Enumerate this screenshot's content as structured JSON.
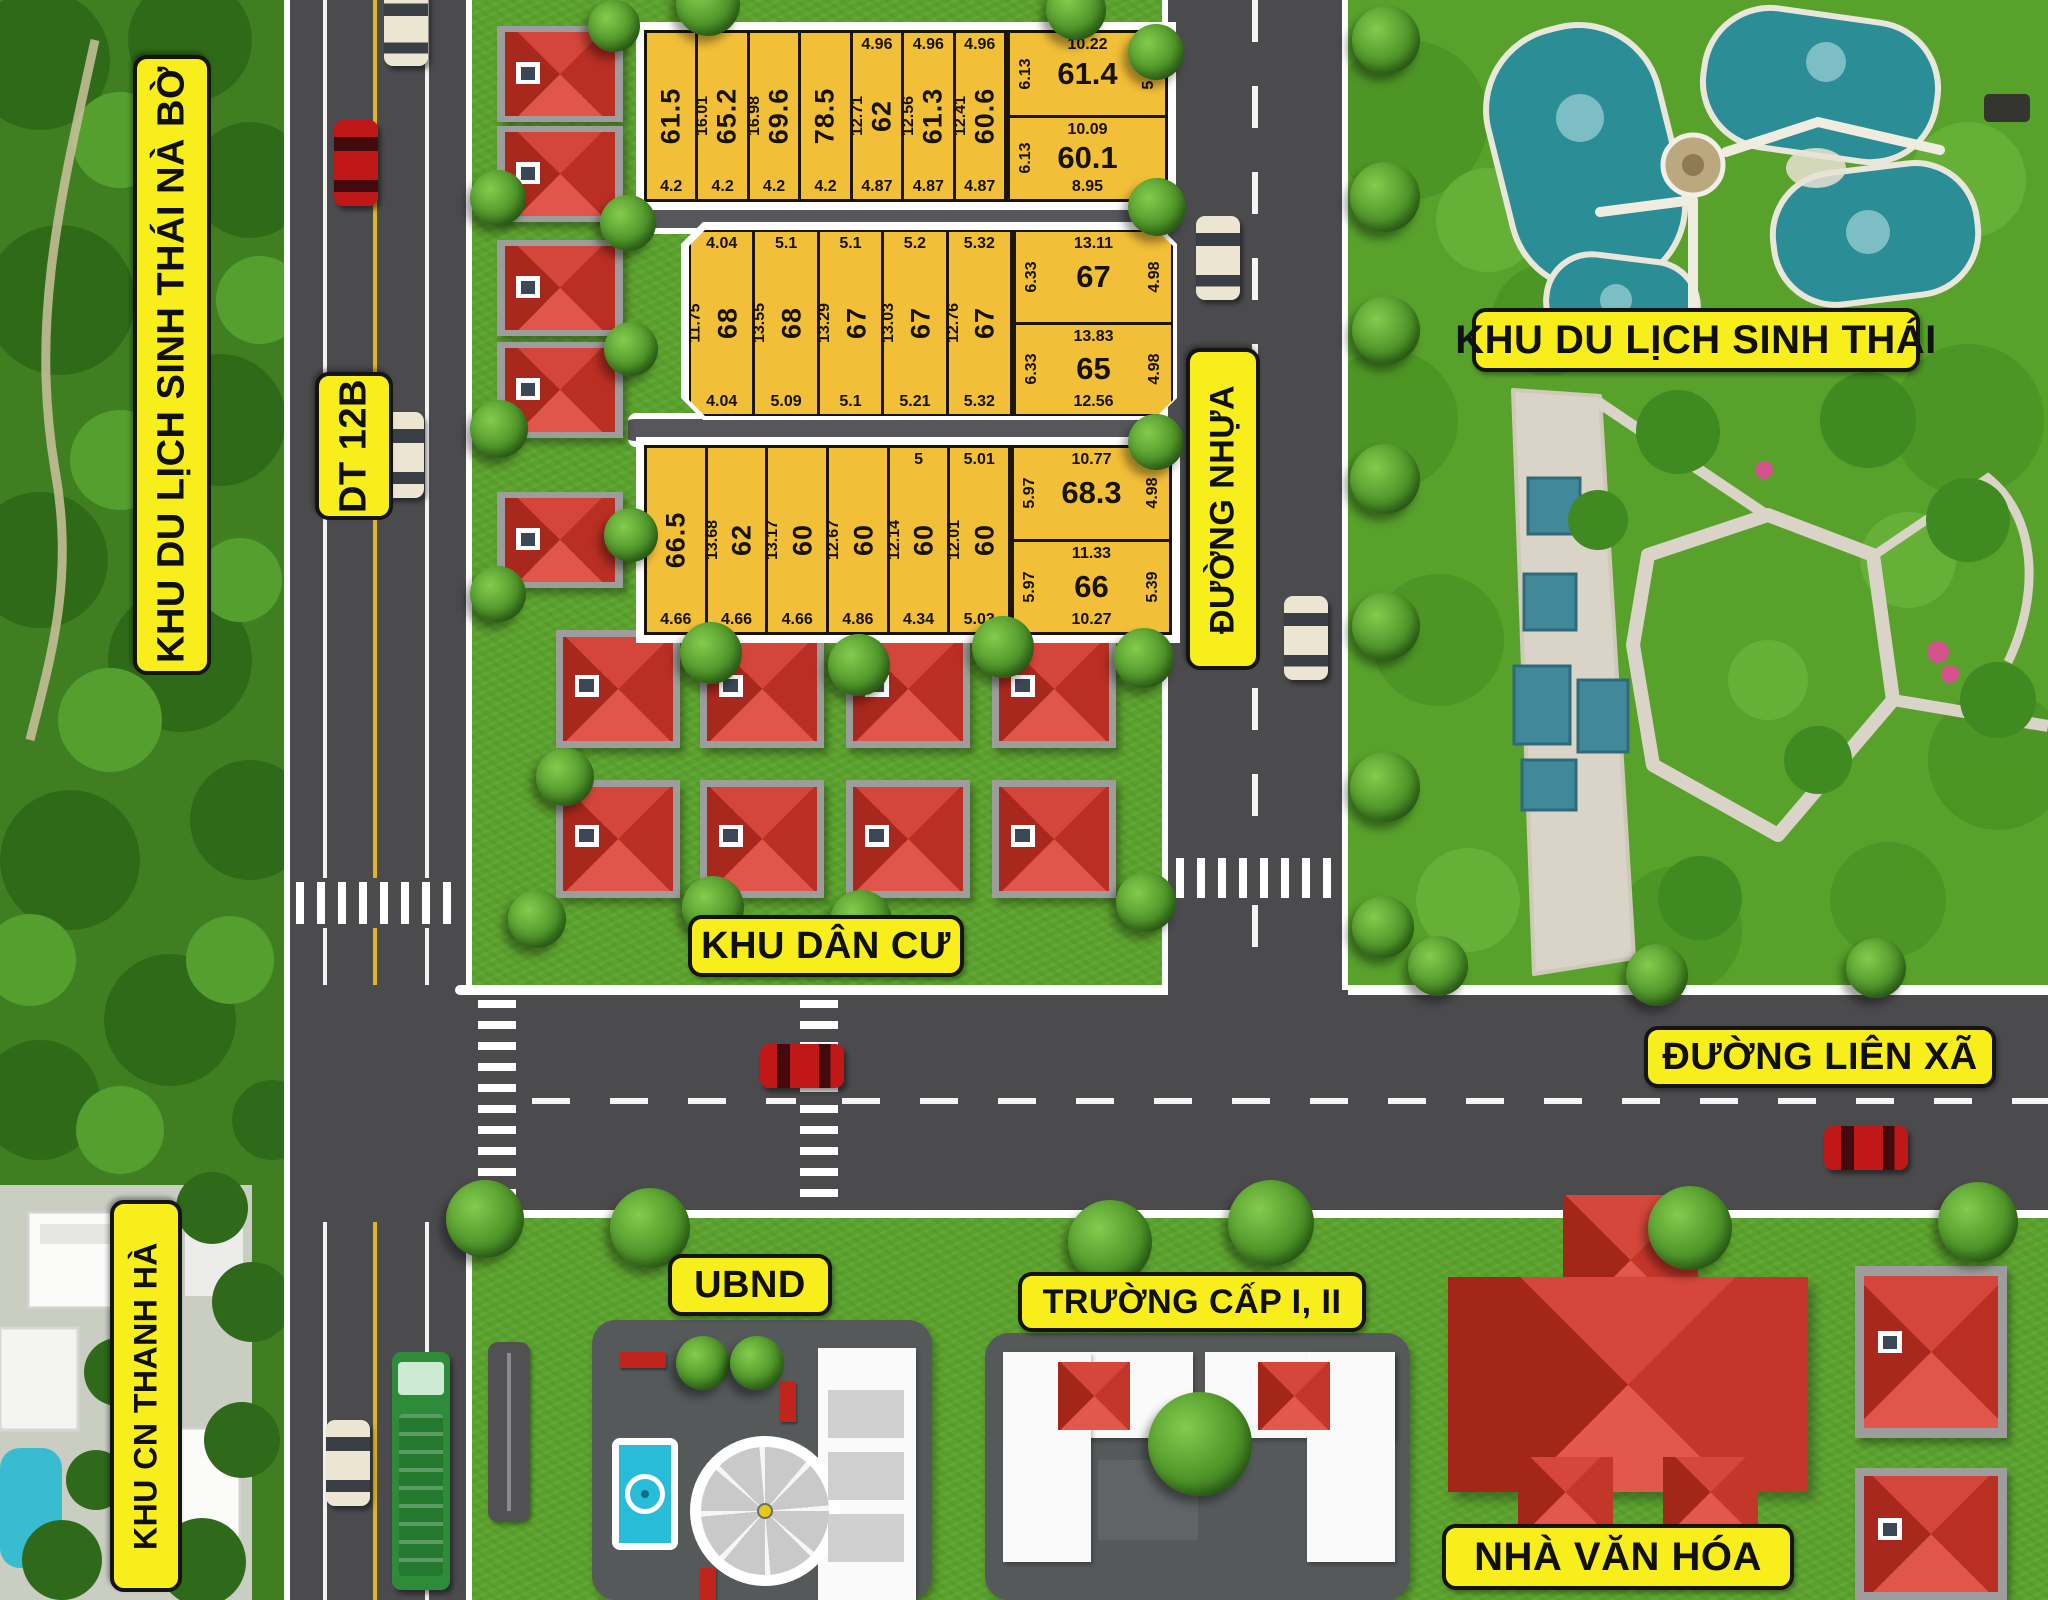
{
  "labels": {
    "zone_eco_naBo": "KHU DU LỊCH SINH THÁI NÀ BỜ",
    "road_dt12b": "DT 12B",
    "zone_eco_park": "KHU DU LỊCH SINH THÁI",
    "road_duong_nhua": "ĐƯỜNG NHỰA",
    "zone_residential": "KHU DÂN CƯ",
    "road_lien_xa": "ĐƯỜNG LIÊN XÃ",
    "ubnd": "UBND",
    "school": "TRƯỜNG CẤP I, II",
    "culture_house": "NHÀ VĂN HÓA",
    "zone_industrial": "KHU CN THANH HÀ"
  },
  "colors": {
    "plot_yellow": "#F2BF38",
    "badge_yellow": "#F7EE1B",
    "road_gray": "#4B4B4E",
    "grass_green": "#5BA22C",
    "roof_red": "#C8382C",
    "pond_teal": "#2B8D96"
  },
  "plot_blocks": {
    "block1": {
      "strips": [
        {
          "area": "61.5",
          "side": "",
          "top": "",
          "bottom": "4.2"
        },
        {
          "area": "65.2",
          "side": "16.01",
          "top": "",
          "bottom": "4.2"
        },
        {
          "area": "69.6",
          "side": "16.98",
          "top": "",
          "bottom": "4.2"
        },
        {
          "area": "78.5",
          "side": "",
          "top": "",
          "bottom": "4.2"
        },
        {
          "area": "62",
          "side": "12.71",
          "top": "4.96",
          "bottom": "4.87"
        },
        {
          "area": "61.3",
          "side": "12.56",
          "top": "4.96",
          "bottom": "4.87"
        },
        {
          "area": "60.6",
          "side": "12.41",
          "top": "4.96",
          "bottom": "4.87"
        }
      ],
      "right_col": [
        {
          "area": "61.4",
          "top": "10.22",
          "left": "6.13",
          "right": "5.98",
          "bottom": ""
        },
        {
          "area": "60.1",
          "top": "10.09",
          "left": "6.13",
          "right": "",
          "bottom": "8.95"
        }
      ]
    },
    "block2": {
      "strips": [
        {
          "area": "68",
          "side": "11.75",
          "top": "4.04",
          "bottom": "4.04"
        },
        {
          "area": "68",
          "side": "13.55",
          "top": "5.1",
          "bottom": "5.09"
        },
        {
          "area": "67",
          "side": "13.29",
          "top": "5.1",
          "bottom": "5.1"
        },
        {
          "area": "67",
          "side": "13.03",
          "top": "5.2",
          "bottom": "5.21"
        },
        {
          "area": "67",
          "side": "12.76",
          "top": "5.32",
          "bottom": "5.32"
        }
      ],
      "right_col": [
        {
          "area": "67",
          "top": "13.11",
          "left": "6.33",
          "right": "4.98",
          "bottom": ""
        },
        {
          "area": "65",
          "top": "13.83",
          "left": "6.33",
          "right": "4.98",
          "bottom": "12.56"
        }
      ]
    },
    "block3": {
      "strips": [
        {
          "area": "66.5",
          "side": "",
          "top": "",
          "bottom": "4.66"
        },
        {
          "area": "62",
          "side": "13.68",
          "top": "",
          "bottom": "4.66"
        },
        {
          "area": "60",
          "side": "13.17",
          "top": "",
          "bottom": "4.66"
        },
        {
          "area": "60",
          "side": "12.67",
          "top": "",
          "bottom": "4.86"
        },
        {
          "area": "60",
          "side": "12.14",
          "top": "5",
          "bottom": "4.34"
        },
        {
          "area": "60",
          "side": "12.01",
          "top": "5.01",
          "bottom": "5.03"
        }
      ],
      "right_col": [
        {
          "area": "68.3",
          "top": "10.77",
          "left": "5.97",
          "right": "4.98",
          "bottom": ""
        },
        {
          "area": "66",
          "top": "11.33",
          "left": "5.97",
          "right": "5.39",
          "bottom": "10.27"
        }
      ]
    }
  },
  "vehicles": [
    {
      "road": "DT 12B",
      "color": "white"
    },
    {
      "road": "DT 12B",
      "color": "red"
    },
    {
      "road": "DT 12B",
      "color": "white"
    },
    {
      "road": "DT 12B",
      "color": "white"
    },
    {
      "road": "DT 12B",
      "color": "green truck"
    },
    {
      "road": "ĐƯỜNG NHỰA",
      "color": "white"
    },
    {
      "road": "ĐƯỜNG NHỰA",
      "color": "white"
    },
    {
      "road": "ĐƯỜNG LIÊN XÃ",
      "color": "red"
    },
    {
      "road": "ĐƯỜNG LIÊN XÃ",
      "color": "red"
    }
  ]
}
